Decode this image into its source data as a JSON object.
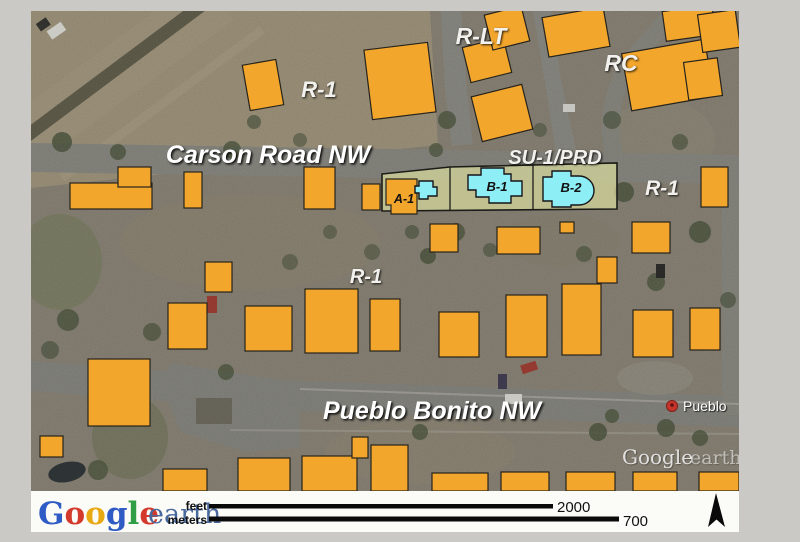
{
  "figure": {
    "kind": "aerial-zoning-map",
    "imagery_source": "Google earth"
  },
  "labels": {
    "road_carson": "Carson Road NW",
    "road_pueblo": "Pueblo Bonito NW",
    "zone_r1_top": "R-1",
    "zone_rlt": "R-LT",
    "zone_rc": "RC",
    "zone_su1_prd": "SU-1/PRD",
    "zone_r1_east": "R-1",
    "zone_r1_center": "R-1",
    "building_a1": "A-1",
    "building_b1": "B-1",
    "building_b2": "B-2"
  },
  "pin": {
    "label": "Pueblo"
  },
  "watermark": {
    "google": "Google",
    "earth": "earth"
  },
  "legend": {
    "logo": {
      "letters": [
        {
          "ch": "G",
          "color": "#2f5bc4"
        },
        {
          "ch": "o",
          "color": "#d33a2c"
        },
        {
          "ch": "o",
          "color": "#e8a912"
        },
        {
          "ch": "g",
          "color": "#2f5bc4"
        },
        {
          "ch": "l",
          "color": "#2f9e44"
        },
        {
          "ch": "e",
          "color": "#d33a2c"
        }
      ],
      "earth_word": "earth",
      "earth_color": "#49699c"
    },
    "scale_feet": {
      "label": "feet",
      "value": "2000"
    },
    "scale_meters": {
      "label": "meters",
      "value": "700"
    }
  },
  "colors": {
    "page_background": "#cac9c5",
    "building_footprint": "#f3a62c",
    "building_selected": "#8deef5",
    "parcel_overlay": "#d8db9e",
    "legend_bar": "#fbfbf7",
    "pin_red": "#c5352b"
  }
}
